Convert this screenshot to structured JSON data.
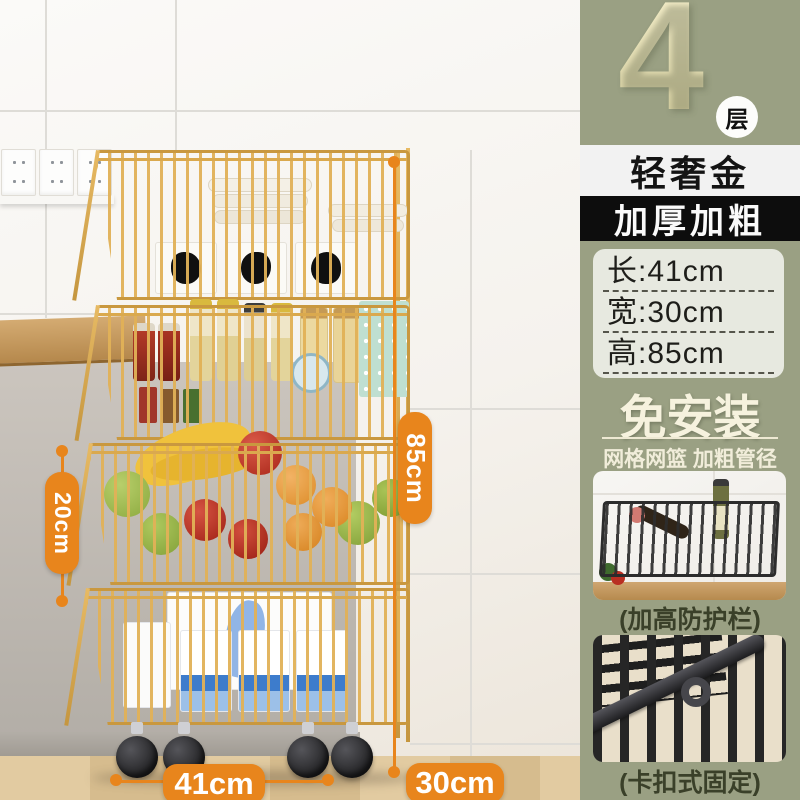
{
  "colors": {
    "accent_orange": "#E8851C",
    "panel_sage": "#9AA083",
    "gold_wire": "#D3A04C",
    "banner_black": "#0D0D0D",
    "banner_white": "#F2F2F2"
  },
  "annotations": {
    "height": "85cm",
    "tier_gap": "20cm",
    "width": "41cm",
    "depth": "30cm"
  },
  "panel": {
    "tier_count": "4",
    "tier_unit": "层",
    "variant_name": "轻奢金",
    "feature_banner": "加厚加粗",
    "spec_rows": [
      "长:41cm",
      "宽:30cm",
      "高:85cm"
    ],
    "headline": "免安装",
    "subheadline": "网格网篮 加粗管径",
    "detail_captions": [
      "(加高防护栏)",
      "(卡扣式固定)"
    ]
  }
}
